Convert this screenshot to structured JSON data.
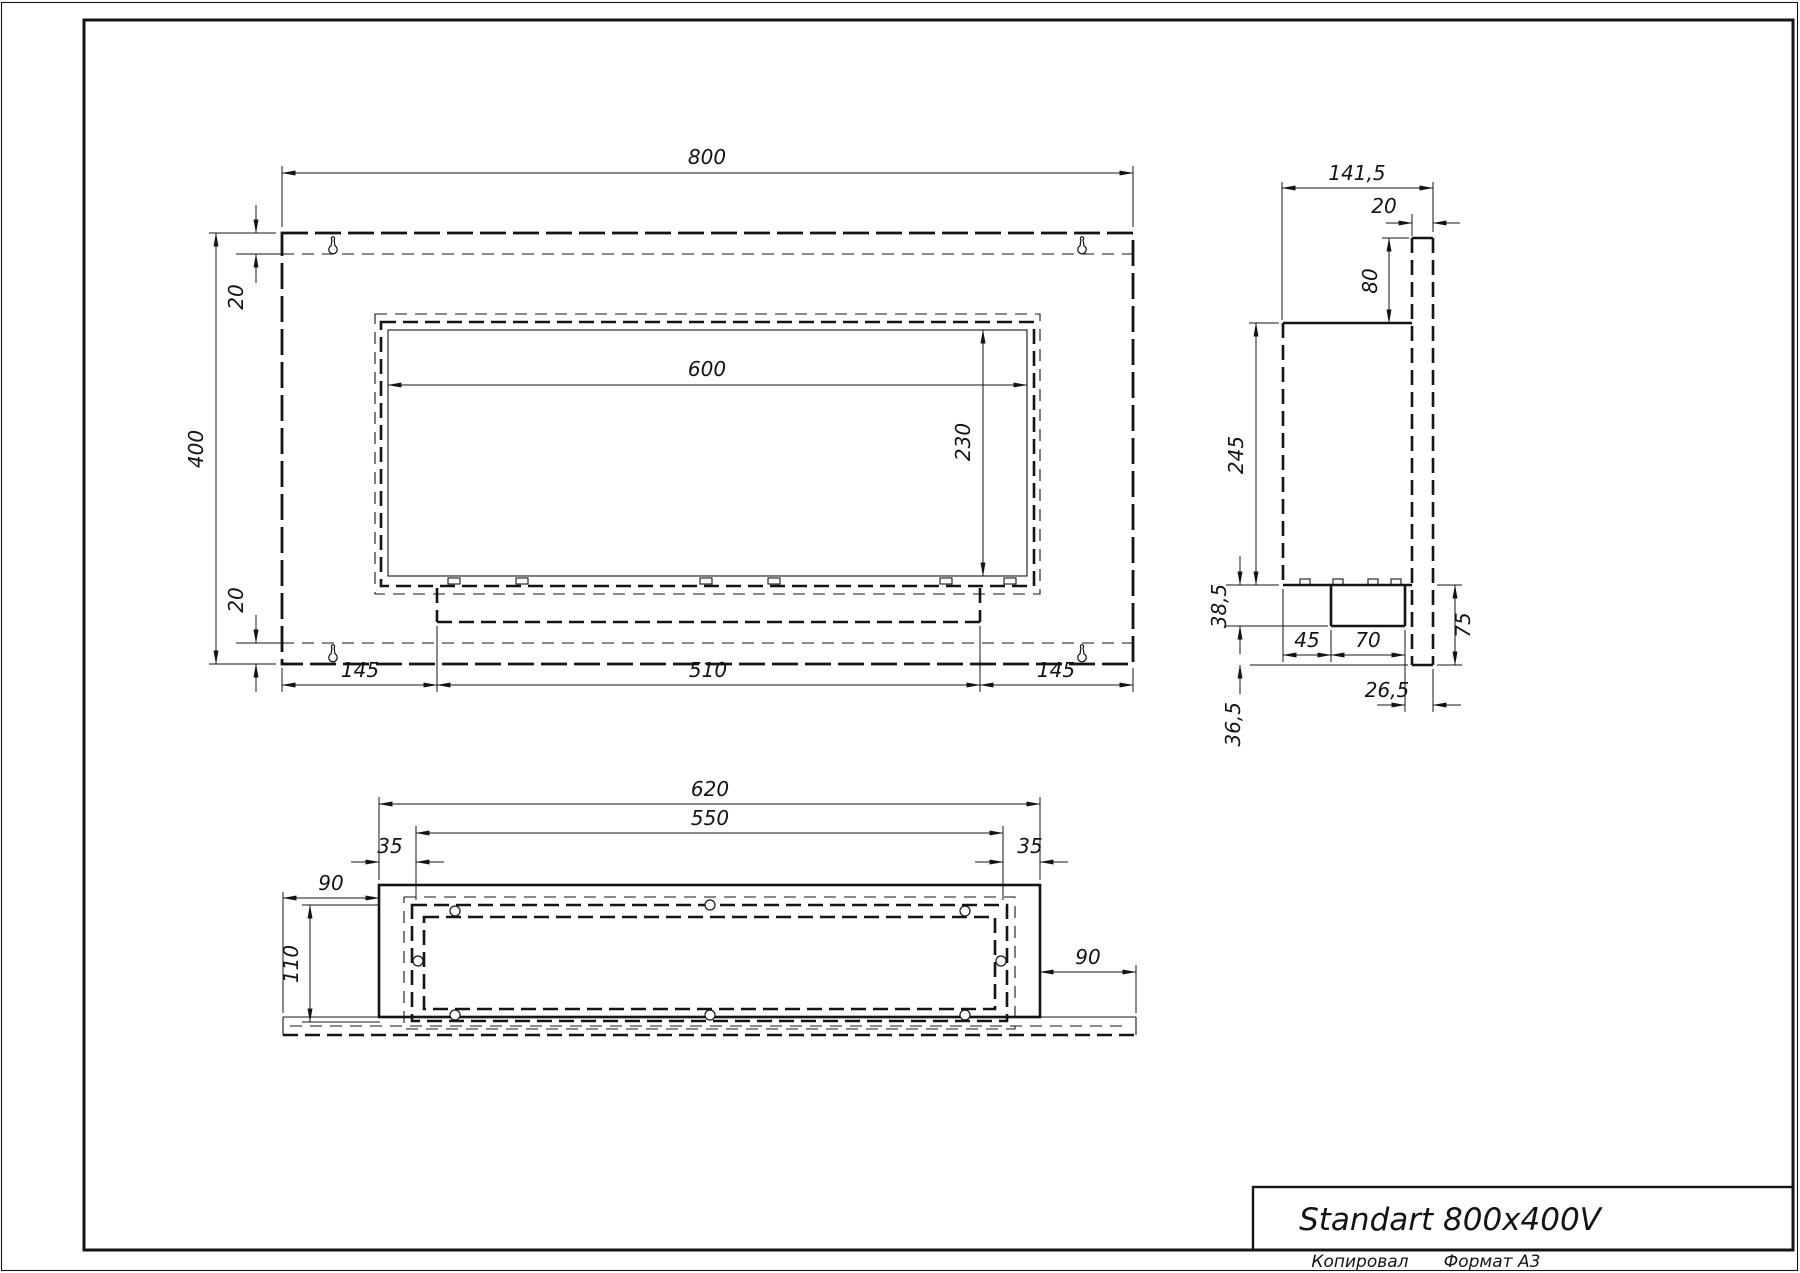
{
  "sheet": {
    "title": "Standart 800x400V",
    "copied_label": "Копировал",
    "format_label": "Формат А3"
  },
  "views": {
    "front": {
      "dims": {
        "overall_width": "800",
        "overall_height": "400",
        "top_inset": "20",
        "bottom_inset": "20",
        "window_width": "600",
        "window_height": "230",
        "left_margin": "145",
        "tray_width": "510",
        "right_margin": "145"
      }
    },
    "side": {
      "dims": {
        "overall_depth": "141,5",
        "plate_thickness": "20",
        "plate_above_body": "80",
        "body_height": "245",
        "tray_drop": "38,5",
        "tray_offset": "45",
        "tray_depth": "70",
        "below_tray": "36,5",
        "plate_overhang": "26,5",
        "bottom_flange": "75"
      }
    },
    "bottom": {
      "dims": {
        "body_width": "620",
        "frame_width": "550",
        "left_inset": "35",
        "right_inset": "35",
        "left_plate": "90",
        "frame_depth": "110",
        "right_plate": "90"
      }
    }
  }
}
